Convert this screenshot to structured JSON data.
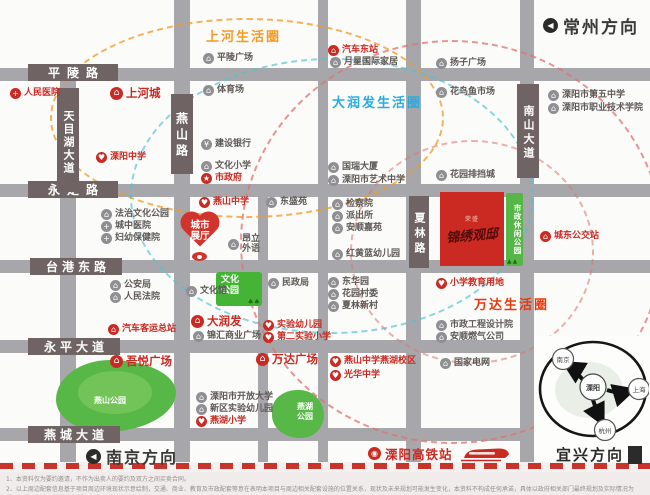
{
  "colors": {
    "accent_red": "#cb2a22",
    "road_gray": "#a7a7ab",
    "label_brown": "#6f6463",
    "park_green": "#57b648",
    "circle_orange": "#f59a23",
    "circle_blue": "#29abe2",
    "circle_red": "#e8380d"
  },
  "roads": {
    "horizontal": [
      "平陵路",
      "永定路",
      "台港东路",
      "永平大道",
      "燕城大道"
    ],
    "vertical": [
      "天目湖大道",
      "燕山路",
      "夏林路",
      "南山大道"
    ]
  },
  "life_circles": [
    {
      "label": "上河生活圈",
      "color": "#f59a23"
    },
    {
      "label": "大润发生活圈",
      "color": "#29abe2"
    },
    {
      "label": "万达生活圈",
      "color": "#e8380d"
    }
  ],
  "directions": {
    "changzhou": "常州方向",
    "nanjing": "南京方向",
    "yixing": "宜兴方向"
  },
  "project": {
    "logo": "荣盛",
    "name": "锦绣观邸"
  },
  "city_hall_pin": {
    "label": "城市\n展厅"
  },
  "parks": [
    {
      "name": "燕山公园"
    },
    {
      "name": "燕湖\n公园"
    },
    {
      "name": "文化\n公园"
    },
    {
      "name": "市政休闲公园"
    }
  ],
  "station": {
    "label": "溧阳高铁站"
  },
  "hub": {
    "center": "溧阳",
    "nodes": [
      "南京",
      "上海",
      "杭州"
    ]
  },
  "pois": [
    {
      "t": "平陵广场",
      "x": 203,
      "y": 53,
      "c": "g",
      "i": "b"
    },
    {
      "t": "月星国际家居",
      "x": 330,
      "y": 57,
      "c": "g",
      "i": "b"
    },
    {
      "t": "体育场",
      "x": 203,
      "y": 85,
      "c": "g",
      "i": "b"
    },
    {
      "t": "扬子广场",
      "x": 436,
      "y": 58,
      "c": "g",
      "i": "b"
    },
    {
      "t": "花鸟鱼市场",
      "x": 436,
      "y": 87,
      "c": "g",
      "i": "b"
    },
    {
      "t": "溧阳市第五中学",
      "x": 548,
      "y": 90,
      "c": "g",
      "i": "b"
    },
    {
      "t": "溧阳市职业技术学院",
      "x": 548,
      "y": 103,
      "c": "g",
      "i": "b"
    },
    {
      "t": "建设银行",
      "x": 201,
      "y": 139,
      "c": "g",
      "i": "y"
    },
    {
      "t": "文化小学",
      "x": 201,
      "y": 161,
      "c": "g",
      "i": "b"
    },
    {
      "t": "国瑞大厦",
      "x": 328,
      "y": 162,
      "c": "g",
      "i": "b"
    },
    {
      "t": "溧阳市艺术中学",
      "x": 328,
      "y": 175,
      "c": "g",
      "i": "b"
    },
    {
      "t": "花园排挡城",
      "x": 436,
      "y": 170,
      "c": "g",
      "i": "b"
    },
    {
      "t": "东盛苑",
      "x": 266,
      "y": 197,
      "c": "g",
      "i": "b"
    },
    {
      "t": "检察院",
      "x": 332,
      "y": 199,
      "c": "g",
      "i": "b"
    },
    {
      "t": "派出所",
      "x": 332,
      "y": 211,
      "c": "g",
      "i": "b"
    },
    {
      "t": "安顺嘉苑",
      "x": 332,
      "y": 223,
      "c": "g",
      "i": "b"
    },
    {
      "t": "红黄蓝幼儿园",
      "x": 332,
      "y": 249,
      "c": "g",
      "i": "b"
    },
    {
      "t": "法治文化公园",
      "x": 101,
      "y": 209,
      "c": "g",
      "i": "b"
    },
    {
      "t": "城中医院",
      "x": 101,
      "y": 221,
      "c": "g",
      "i": "h"
    },
    {
      "t": "妇幼保健院",
      "x": 101,
      "y": 233,
      "c": "g",
      "i": "h"
    },
    {
      "t": "昂立\n外语",
      "x": 228,
      "y": 234,
      "c": "g",
      "i": "b"
    },
    {
      "t": "文化馆",
      "x": 186,
      "y": 286,
      "c": "g",
      "i": "b"
    },
    {
      "t": "民政局",
      "x": 268,
      "y": 278,
      "c": "g",
      "i": "b"
    },
    {
      "t": "东华园",
      "x": 328,
      "y": 277,
      "c": "g",
      "i": "b"
    },
    {
      "t": "花园村委",
      "x": 328,
      "y": 289,
      "c": "g",
      "i": "b"
    },
    {
      "t": "夏林新村",
      "x": 328,
      "y": 301,
      "c": "g",
      "i": "b"
    },
    {
      "t": "锦汇商业广场",
      "x": 193,
      "y": 331,
      "c": "g",
      "i": "b"
    },
    {
      "t": "公安局",
      "x": 110,
      "y": 280,
      "c": "g",
      "i": "b"
    },
    {
      "t": "人民法院",
      "x": 110,
      "y": 292,
      "c": "g",
      "i": "b"
    },
    {
      "t": "溧阳市开放大学",
      "x": 196,
      "y": 392,
      "c": "g",
      "i": "b"
    },
    {
      "t": "新区实验幼儿园",
      "x": 196,
      "y": 404,
      "c": "g",
      "i": "b"
    },
    {
      "t": "市政工程设计院",
      "x": 436,
      "y": 320,
      "c": "g",
      "i": "b"
    },
    {
      "t": "安顺燃气公司",
      "x": 436,
      "y": 332,
      "c": "g",
      "i": "b"
    },
    {
      "t": "国家电网",
      "x": 440,
      "y": 358,
      "c": "g",
      "i": "b"
    },
    {
      "t": "人民医院",
      "x": 10,
      "y": 88,
      "c": "r",
      "i": "h"
    },
    {
      "t": "上河城",
      "x": 110,
      "y": 87,
      "c": "r",
      "i": "m",
      "big": 1
    },
    {
      "t": "汽车东站",
      "x": 328,
      "y": 45,
      "c": "r",
      "i": "bus"
    },
    {
      "t": "溧阳中学",
      "x": 96,
      "y": 152,
      "c": "r",
      "i": "p"
    },
    {
      "t": "市政府",
      "x": 201,
      "y": 173,
      "c": "r",
      "i": "s"
    },
    {
      "t": "燕山中学",
      "x": 199,
      "y": 197,
      "c": "r",
      "i": "p"
    },
    {
      "t": "大润发",
      "x": 191,
      "y": 315,
      "c": "r",
      "i": "m",
      "big": 1
    },
    {
      "t": "实验幼儿园",
      "x": 263,
      "y": 320,
      "c": "r",
      "i": "p"
    },
    {
      "t": "第二实验小学",
      "x": 263,
      "y": 332,
      "c": "r",
      "i": "p"
    },
    {
      "t": "汽车客运总站",
      "x": 108,
      "y": 324,
      "c": "r",
      "i": "bus"
    },
    {
      "t": "吾悦广场",
      "x": 110,
      "y": 355,
      "c": "r",
      "i": "m",
      "big": 1
    },
    {
      "t": "万达广场",
      "x": 256,
      "y": 353,
      "c": "r",
      "i": "m",
      "big": 1
    },
    {
      "t": "燕山中学燕湖校区",
      "x": 330,
      "y": 356,
      "c": "r",
      "i": "p"
    },
    {
      "t": "光华中学",
      "x": 330,
      "y": 370,
      "c": "r",
      "i": "p"
    },
    {
      "t": "燕湖小学",
      "x": 196,
      "y": 416,
      "c": "r",
      "i": "p"
    },
    {
      "t": "小学教育用地",
      "x": 436,
      "y": 278,
      "c": "r",
      "i": "p"
    },
    {
      "t": "城东公交站",
      "x": 540,
      "y": 231,
      "c": "r",
      "i": "bus"
    }
  ],
  "disclaimer": [
    "1、本资料仅为要约邀请，不作为出卖人的要约及双方之间买卖合同。",
    "2、以上周边配套信息基于项目周边环境现状示意绘制，交通、商业、教育及市政配套等意在表明本项目与周边相关配套设施的位置关系，现状及未来规划可能发生变化，本资料不构成任何承诺，具体以政府相关部门最终规划及实际情况为准，开发商保留对宣传资料进行解释及相应调整的权利。"
  ]
}
